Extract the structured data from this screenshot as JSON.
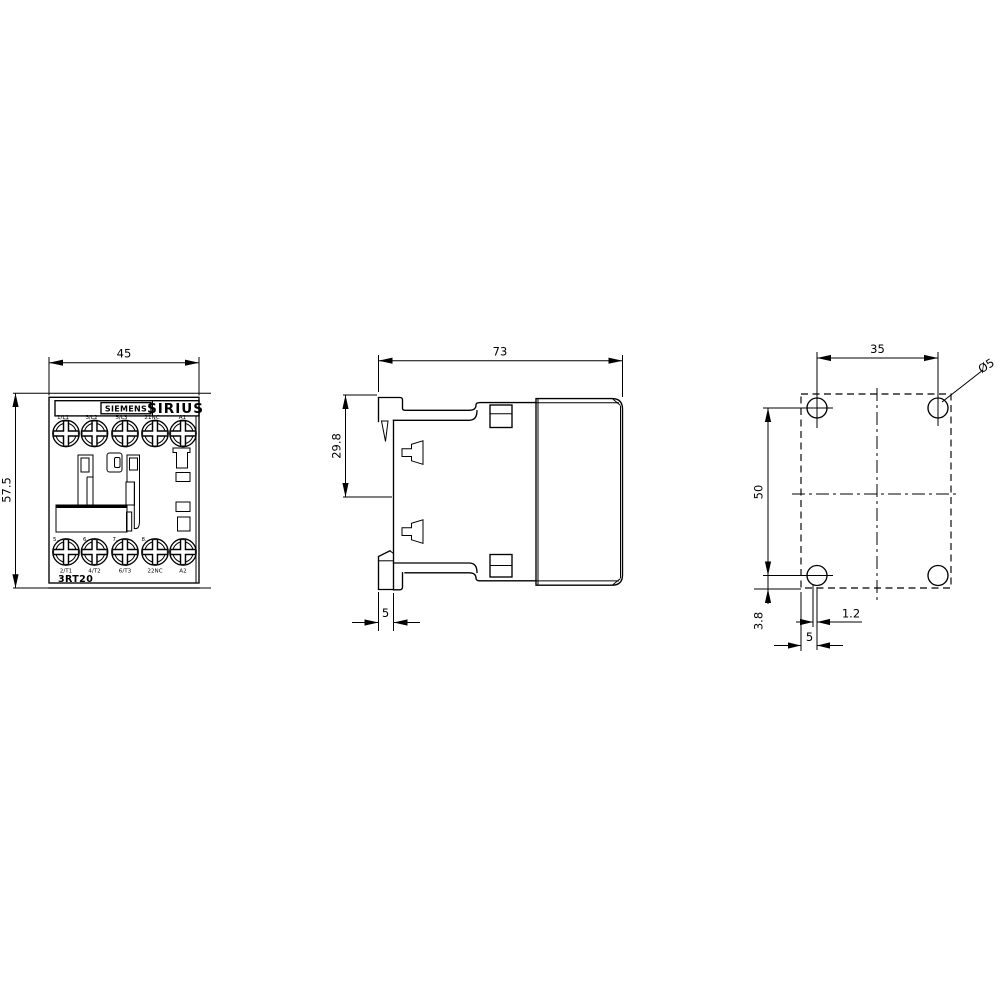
{
  "front_view": {
    "brand": "SIEMENS",
    "series": "SIRIUS",
    "model": "3RT20",
    "dim_width": "45",
    "dim_height": "57.5",
    "top_terminals": [
      "1/L1",
      "3/L2",
      "5/L3",
      "21NC",
      "A1"
    ],
    "bottom_terminals": [
      "2/T1",
      "4/T2",
      "6/T3",
      "22NC",
      "A2"
    ],
    "pole_marks": [
      "5.",
      "6.",
      "7.",
      "8."
    ]
  },
  "side_view": {
    "dim_depth": "73",
    "dim_rail_height": "29.8",
    "dim_rail_depth": "5"
  },
  "drill_view": {
    "dim_hole_spacing_h": "35",
    "dim_hole_spacing_v": "50",
    "dim_bottom_offset": "3.8",
    "dim_center_offset": "1.2",
    "dim_edge_offset": "5",
    "hole_diameter": "Ø5"
  },
  "colors": {
    "line": "#000000",
    "background": "#ffffff"
  }
}
